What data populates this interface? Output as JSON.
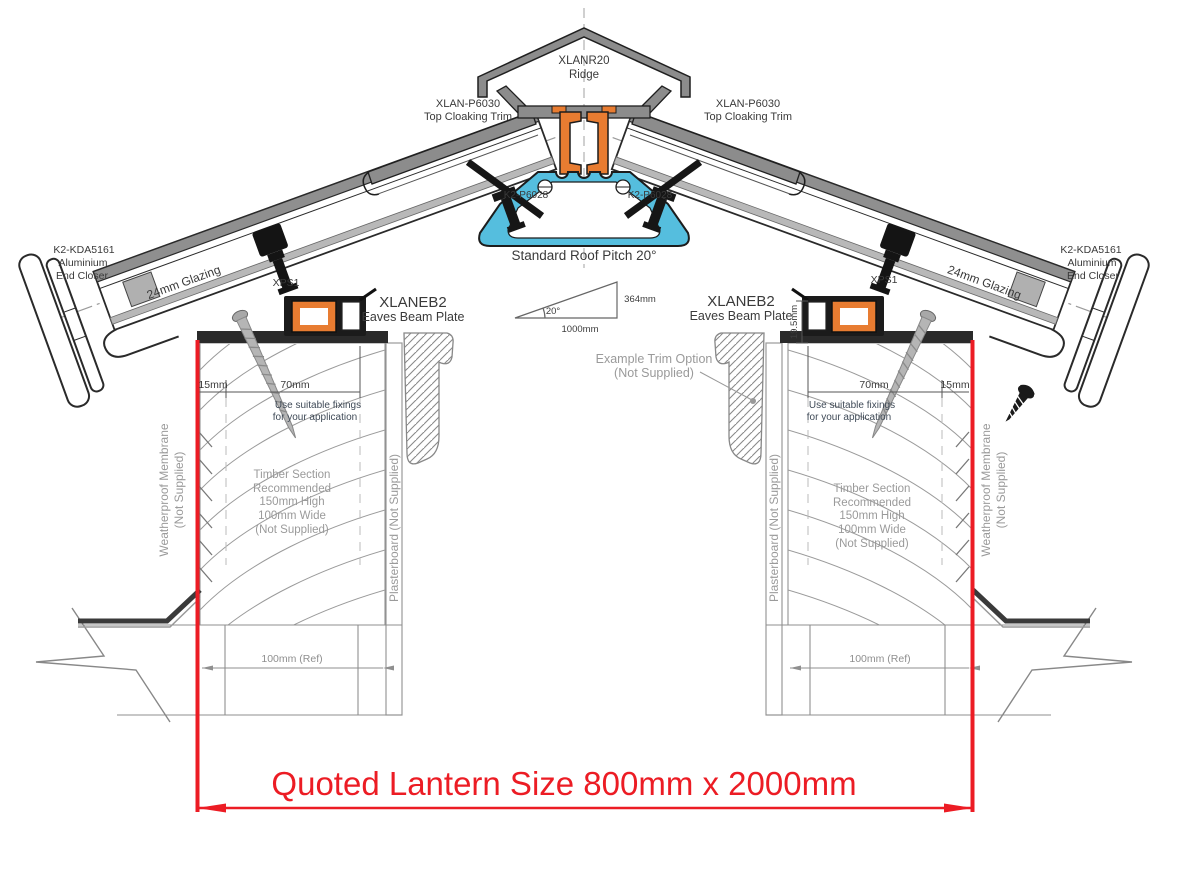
{
  "drawing": {
    "title": "Roof lantern cross section",
    "ridge": {
      "code": "XLANR20",
      "name": "Ridge"
    },
    "cloaking_trim": {
      "code": "XLAN-P6030",
      "name": "Top Cloaking Trim"
    },
    "glazing_bar_code": "K2-P6028",
    "pitch": {
      "label": "Standard Roof Pitch 20°",
      "angle": "20°",
      "rise": "364mm",
      "run": "1000mm"
    },
    "end_closer": {
      "code": "K2-KDA5161",
      "line2": "Aluminium",
      "line3": "End Closer"
    },
    "glazing": "24mm Glazing",
    "xps": "XPS1",
    "eaves_beam": {
      "code": "XLANEB2",
      "name": "Eaves Beam Plate"
    },
    "trim_option": {
      "line1": "Example Trim Option",
      "line2": "(Not Supplied)"
    },
    "fixings_note": {
      "line1": "Use suitable fixings",
      "line2": "for your application"
    },
    "timber_note": {
      "line1": "Timber Section",
      "line2": "Recommended",
      "line3": "150mm High",
      "line4": "100mm Wide",
      "line5": "(Not Supplied)"
    },
    "membrane": {
      "line1": "Weatherproof Membrane",
      "line2": "(Not Supplied)"
    },
    "plasterboard": "Plasterboard (Not Supplied)",
    "dims": {
      "edge": "15mm",
      "fixing_zone": "70mm",
      "beam_height": "19.5mm",
      "wall_ref": "100mm (Ref)"
    },
    "quoted_size": "Quoted Lantern Size 800mm x 2000mm"
  },
  "colors": {
    "red": "#ec1c24",
    "blue": "#55bede",
    "orange": "#e87c31",
    "metal_gray": "#8c8c8c",
    "note_gray": "#9a9a9a"
  }
}
